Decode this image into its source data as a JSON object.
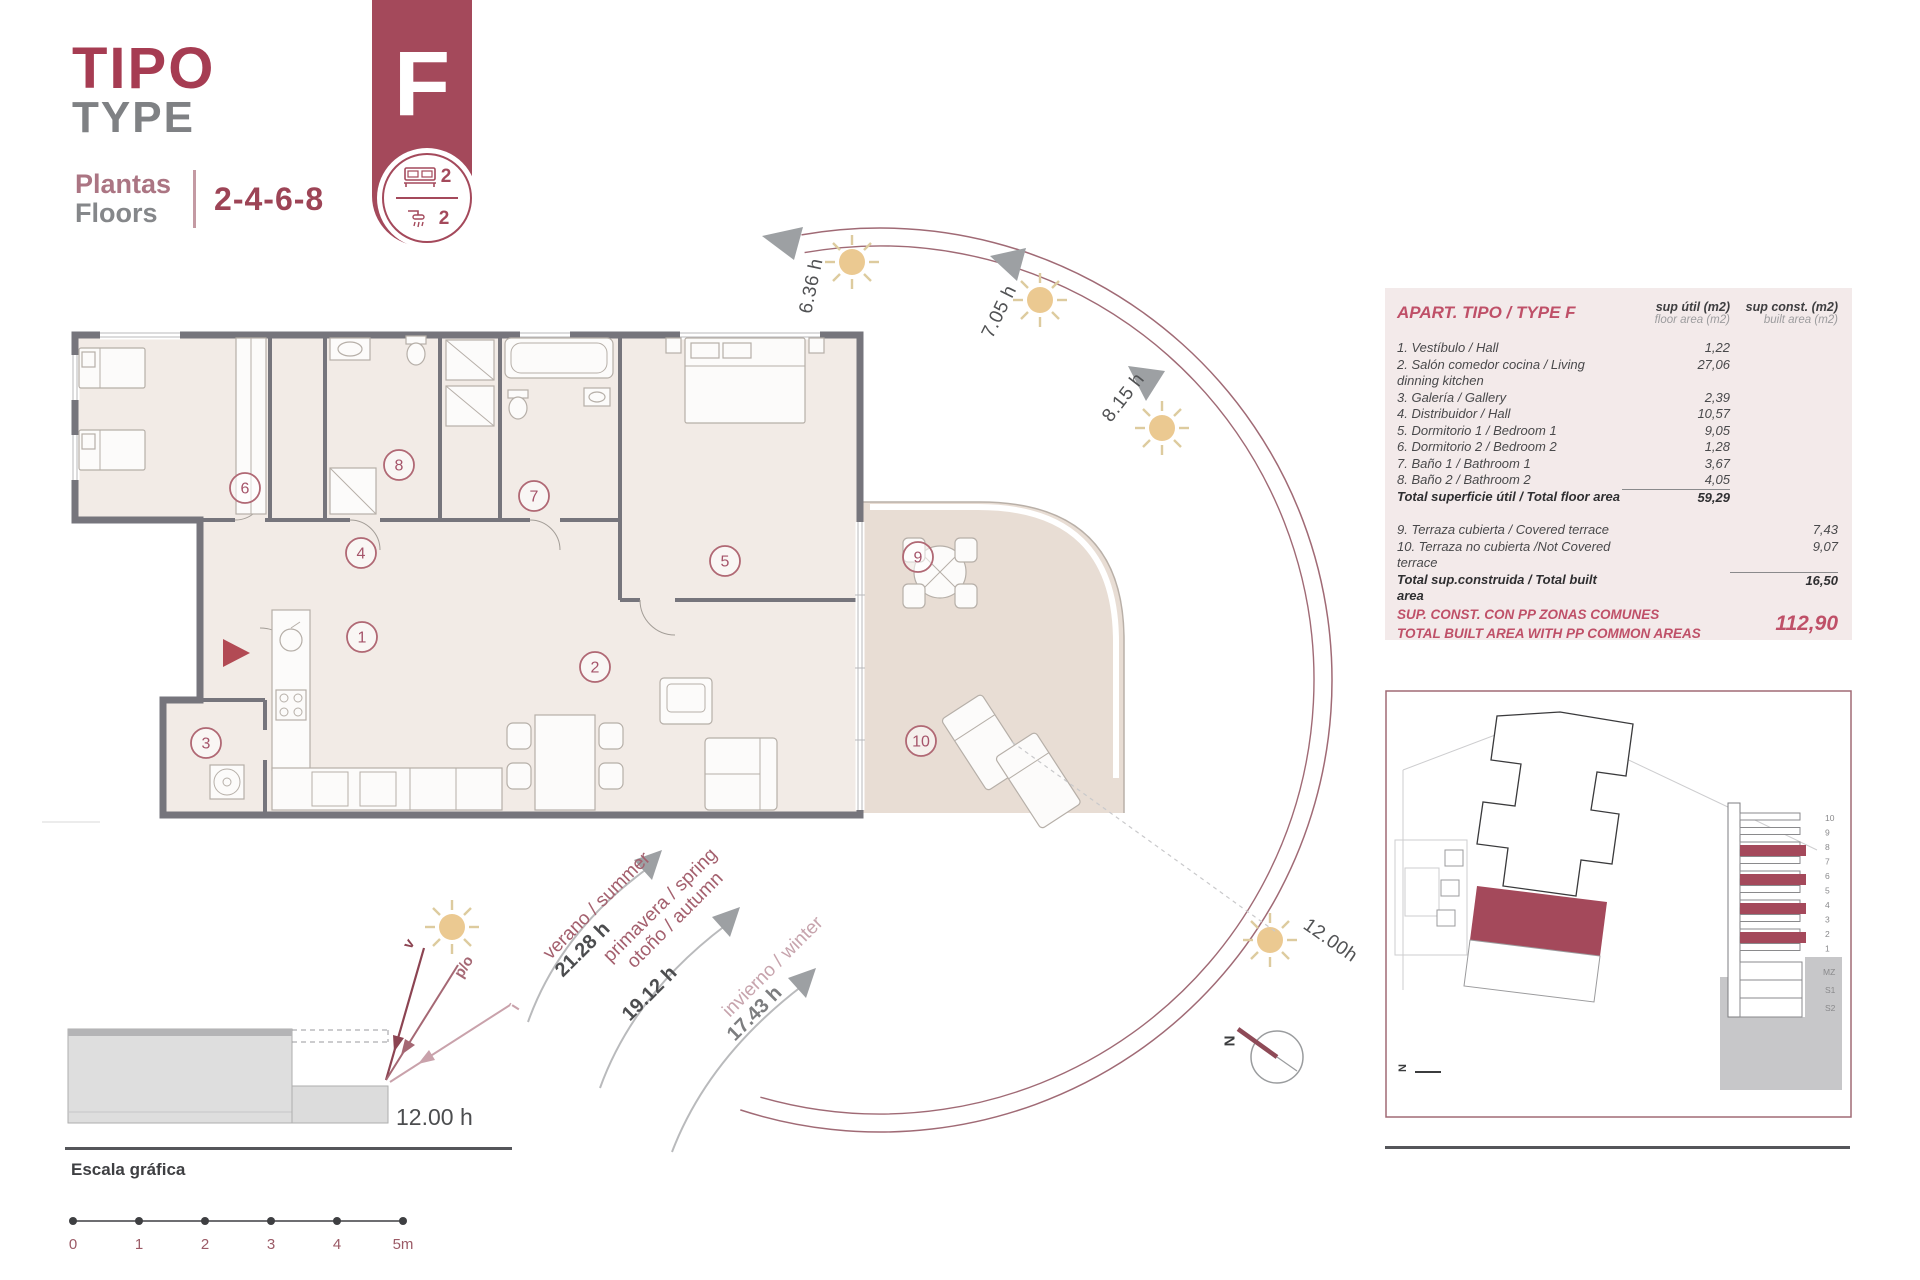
{
  "header": {
    "title_primary": "TIPO",
    "title_secondary": "TYPE",
    "floors_label_line1": "Plantas",
    "floors_label_line2": "Floors",
    "floors_value": "2-4-6-8"
  },
  "type_badge": {
    "letter": "F",
    "bedrooms": "2",
    "bathrooms": "2"
  },
  "accent_colors": {
    "maroon": "#a4495b",
    "table_accent": "#bf5068",
    "sun": "#ebc991"
  },
  "floor_plan": {
    "rooms": [
      {
        "number": "1"
      },
      {
        "number": "2"
      },
      {
        "number": "3"
      },
      {
        "number": "4"
      },
      {
        "number": "5"
      },
      {
        "number": "6"
      },
      {
        "number": "7"
      },
      {
        "number": "8"
      },
      {
        "number": "9"
      },
      {
        "number": "10"
      }
    ]
  },
  "sun_study": {
    "hour_marks": [
      {
        "label": "6.36 h"
      },
      {
        "label": "7.05 h"
      },
      {
        "label": "8.15 h"
      },
      {
        "label": "12.00h"
      }
    ],
    "seasons": [
      {
        "name": "verano / summer",
        "hours": "21.28 h"
      },
      {
        "name": "primavera / spring",
        "name2": "otoño / autumn",
        "hours": "19.12 h"
      },
      {
        "name": "invierno / winter",
        "hours": "17.43 h"
      }
    ],
    "compass_label": "N"
  },
  "section_study": {
    "ray_labels": [
      {
        "label": "v"
      },
      {
        "label": "p/o"
      },
      {
        "label": "i"
      }
    ],
    "hour": "12.00 h"
  },
  "area_table": {
    "title": "APART. TIPO / TYPE F",
    "columns": {
      "floor_title": "sup útil (m2)",
      "floor_sub": "floor area (m2)",
      "built_title": "sup const. (m2)",
      "built_sub": "built area (m2)"
    },
    "rows": [
      {
        "label": "1. Vestíbulo / Hall",
        "floor": "1,22"
      },
      {
        "label": "2. Salón comedor cocina / Living dinning kitchen",
        "floor": "27,06"
      },
      {
        "label": "3. Galería / Gallery",
        "floor": "2,39"
      },
      {
        "label": "4. Distribuidor / Hall",
        "floor": "10,57"
      },
      {
        "label": "5. Dormitorio 1 / Bedroom 1",
        "floor": "9,05"
      },
      {
        "label": "6. Dormitorio 2 / Bedroom 2",
        "floor": "1,28"
      },
      {
        "label": "7. Baño 1 / Bathroom 1",
        "floor": "3,67"
      },
      {
        "label": "8. Baño 2 / Bathroom 2",
        "floor": "4,05"
      }
    ],
    "total_floor": {
      "label": "Total superficie útil / Total floor area",
      "value": "59,29"
    },
    "terrace_rows": [
      {
        "label": "9. Terraza cubierta / Covered terrace",
        "built": "7,43"
      },
      {
        "label": "10. Terraza no cubierta /Not Covered terrace",
        "built": "9,07"
      }
    ],
    "total_built": {
      "label": "Total sup.construida / Total built area",
      "value": "16,50"
    },
    "common_areas": {
      "label_line1": "SUP. CONST. CON PP ZONAS COMUNES",
      "label_line2": "TOTAL BUILT AREA WITH PP COMMON AREAS",
      "value": "112,90"
    }
  },
  "site_plan": {
    "floor_labels": [
      "10",
      "9",
      "8",
      "7",
      "6",
      "5",
      "4",
      "3",
      "2",
      "1",
      "MZ",
      "S1",
      "S2"
    ],
    "north_label": "N"
  },
  "scale_bar": {
    "title": "Escala gráfica",
    "ticks": [
      "0",
      "1",
      "2",
      "3",
      "4",
      "5m"
    ]
  }
}
